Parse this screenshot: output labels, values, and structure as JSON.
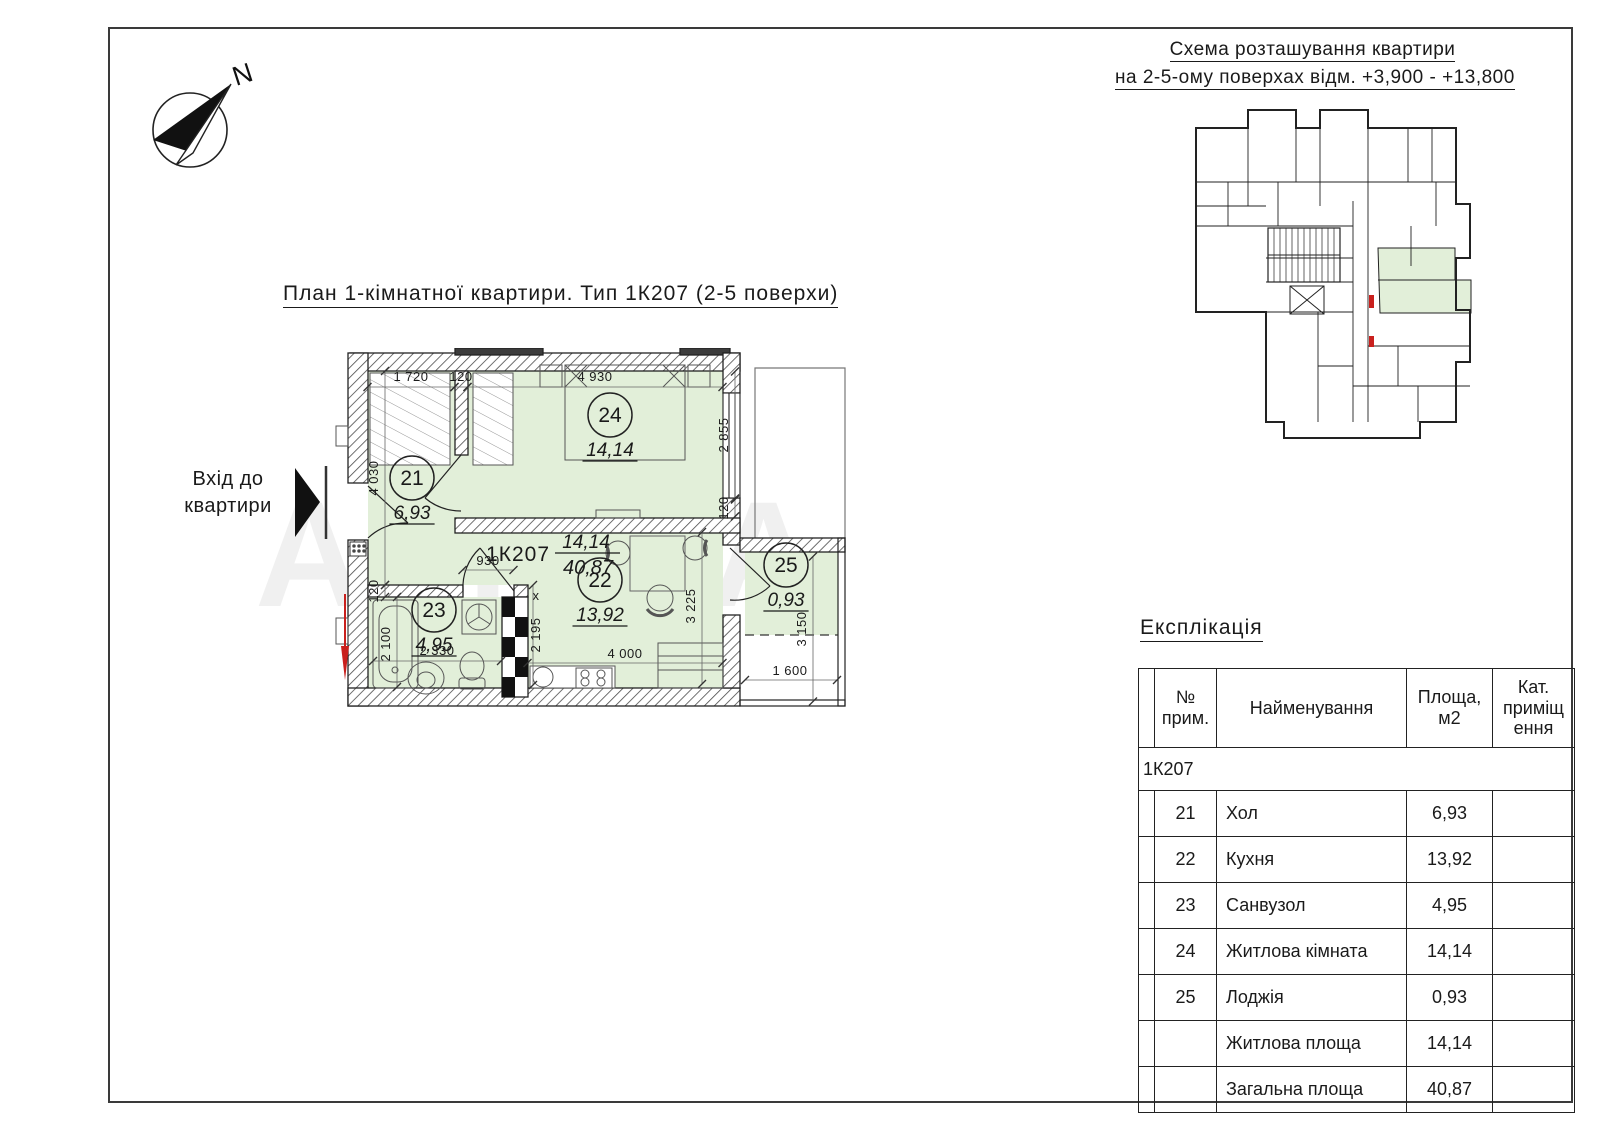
{
  "page": {
    "bg": "#ffffff",
    "frame_color": "#3a3a3a"
  },
  "colors": {
    "room_fill": "#e2efd9",
    "line": "#222222",
    "red": "#c9201d",
    "wall_dark": "#3c3c3c"
  },
  "compass": {
    "north_label": "N"
  },
  "watermark": "АЛМА",
  "plan": {
    "title": "План 1-кімнатної квартири. Тип 1К207 (2-5 поверхи)",
    "entrance_line1": "Вхід до",
    "entrance_line2": "квартири",
    "code": "1К207",
    "area_top": "14,14",
    "area_bottom": "40,87",
    "rooms": [
      {
        "num": "21",
        "area": "6,93",
        "cx": 172,
        "cy": 130
      },
      {
        "num": "22",
        "area": "13,92",
        "cx": 360,
        "cy": 232
      },
      {
        "num": "23",
        "area": "4,95",
        "cx": 194,
        "cy": 262
      },
      {
        "num": "24",
        "area": "14,14",
        "cx": 370,
        "cy": 67
      },
      {
        "num": "25",
        "area": "0,93",
        "cx": 546,
        "cy": 217
      }
    ],
    "dimensions": [
      {
        "t": "1 720",
        "x": 171,
        "y": 33,
        "r": 0,
        "lx": 171,
        "ly": 39,
        "len": 87
      },
      {
        "t": "120",
        "x": 221,
        "y": 33,
        "r": 0,
        "lx": 221,
        "ly": 39,
        "len": 13
      },
      {
        "t": "4 930",
        "x": 355,
        "y": 33,
        "r": 0,
        "lx": 355,
        "ly": 39,
        "len": 255
      },
      {
        "t": "2 855",
        "x": 488,
        "y": 87,
        "r": -90,
        "lx": 495,
        "ly": 87,
        "len": 127
      },
      {
        "t": "120",
        "x": 488,
        "y": 160,
        "r": -90,
        "lx": 495,
        "ly": 160,
        "len": 17
      },
      {
        "t": "4 030",
        "x": 138,
        "y": 130,
        "r": -90,
        "lx": 145,
        "ly": 130,
        "len": 214
      },
      {
        "t": "120",
        "x": 138,
        "y": 243,
        "r": -90,
        "lx": 145,
        "ly": 243,
        "len": 12
      },
      {
        "t": "930",
        "x": 248,
        "y": 217,
        "r": 0,
        "lx": 248,
        "ly": 222,
        "len": 51
      },
      {
        "t": "2 100",
        "x": 150,
        "y": 296,
        "r": -90,
        "lx": 157,
        "ly": 294,
        "len": 90
      },
      {
        "t": "2 330",
        "x": 197,
        "y": 307,
        "r": 0,
        "lx": 197,
        "ly": 313,
        "len": 128
      },
      {
        "t": "х",
        "x": 296,
        "y": 252,
        "r": 0
      },
      {
        "t": "2 195",
        "x": 300,
        "y": 287,
        "r": -90,
        "lx": 293,
        "ly": 287,
        "len": 100
      },
      {
        "t": "4 000",
        "x": 385,
        "y": 310,
        "r": 0,
        "lx": 385,
        "ly": 315,
        "len": 195
      },
      {
        "t": "3 225",
        "x": 455,
        "y": 258,
        "r": -90,
        "lx": 462,
        "ly": 260,
        "len": 152
      },
      {
        "t": "3 150",
        "x": 566,
        "y": 281,
        "r": -90,
        "lx": 573,
        "ly": 281,
        "len": 145
      },
      {
        "t": "1 600",
        "x": 550,
        "y": 327,
        "r": 0,
        "lx": 551,
        "ly": 332,
        "len": 92
      }
    ]
  },
  "scheme": {
    "title_line1": "Схема розташування квартири",
    "title_line2": "на 2-5-ому поверхах відм. +3,900 - +13,800"
  },
  "explication": {
    "title": "Експлікація",
    "headers": {
      "num_l1": "№",
      "num_l2": "прим.",
      "name": "Найменування",
      "area_l1": "Площа,",
      "area_l2": "м2",
      "cat_l1": "Кат.",
      "cat_l2": "приміщ",
      "cat_l3": "ення"
    },
    "group": "1К207",
    "rows": [
      {
        "num": "21",
        "name": "Хол",
        "area": "6,93"
      },
      {
        "num": "22",
        "name": "Кухня",
        "area": "13,92"
      },
      {
        "num": "23",
        "name": "Санвузол",
        "area": "4,95"
      },
      {
        "num": "24",
        "name": "Житлова кімната",
        "area": "14,14"
      },
      {
        "num": "25",
        "name": "Лоджія",
        "area": "0,93"
      },
      {
        "num": "",
        "name": "Житлова площа",
        "area": "14,14"
      },
      {
        "num": "",
        "name": "Загальна площа",
        "area": "40,87"
      }
    ]
  }
}
